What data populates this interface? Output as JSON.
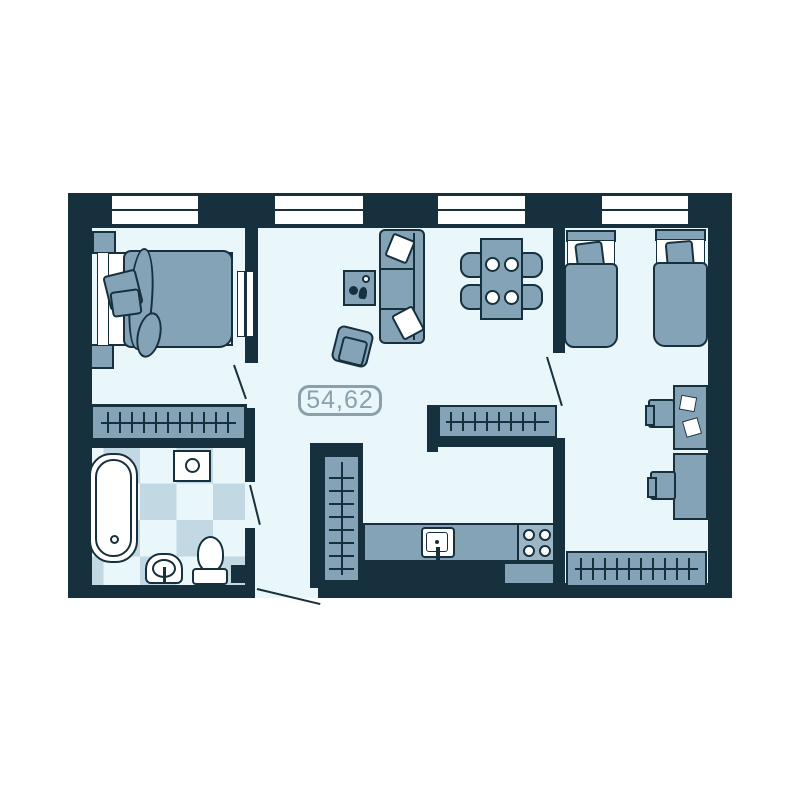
{
  "plan": {
    "area_label": "54,62",
    "windows_count": 4,
    "colors": {
      "background": "#ffffff",
      "wall": "#16303e",
      "floor": "#e9f6fa",
      "furniture": "#85a3b7",
      "stove": "#9db6c6",
      "tile": "#c2d9e4",
      "label": "#8aa1ac"
    },
    "rooms": [
      {
        "name": "bedroom-1",
        "furniture": [
          "double-bed",
          "nightstand",
          "nightstand",
          "wardrobe"
        ]
      },
      {
        "name": "living-room",
        "furniture": [
          "sofa",
          "coffee-table",
          "armchair",
          "dining-table",
          "chairs",
          "wardrobe"
        ]
      },
      {
        "name": "kitchen",
        "furniture": [
          "counter",
          "sink",
          "stove"
        ]
      },
      {
        "name": "bathroom",
        "furniture": [
          "bathtub",
          "washbasin",
          "pedestal-sink",
          "toilet"
        ]
      },
      {
        "name": "bedroom-2",
        "furniture": [
          "single-bed",
          "single-bed",
          "desk",
          "desk",
          "chair",
          "chair",
          "wardrobe"
        ]
      },
      {
        "name": "hallway",
        "furniture": [
          "closet"
        ]
      }
    ]
  }
}
